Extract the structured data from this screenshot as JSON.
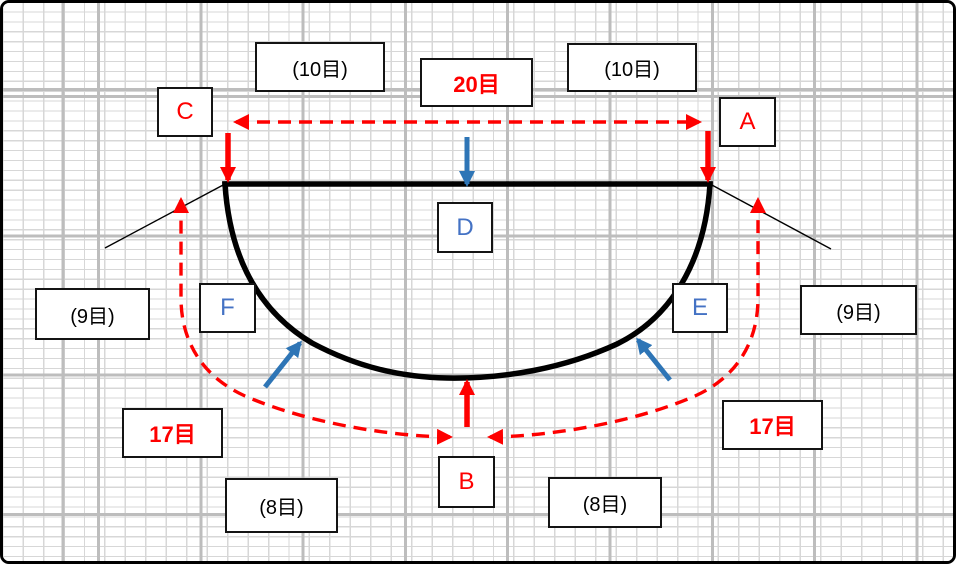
{
  "labels": {
    "top_left_count": "(10目)",
    "top_center_count": "20目",
    "top_right_count": "(10目)",
    "point_c": "C",
    "point_a": "A",
    "point_d": "D",
    "point_f": "F",
    "point_e": "E",
    "point_b": "B",
    "left_side_count": "(9目)",
    "right_side_count": "(9目)",
    "left_curve_count": "17目",
    "right_curve_count": "17目",
    "bottom_left_count": "(8目)",
    "bottom_right_count": "(8目)"
  },
  "colors": {
    "red": "#fe0000",
    "arrow-blue": "#2e75b6",
    "letter-blue": "#4472c4",
    "grid-thin": "#d7d7d7",
    "grid-thick": "#bdbdbd",
    "box-border": "#141414",
    "box-bg": "#ffffff"
  }
}
